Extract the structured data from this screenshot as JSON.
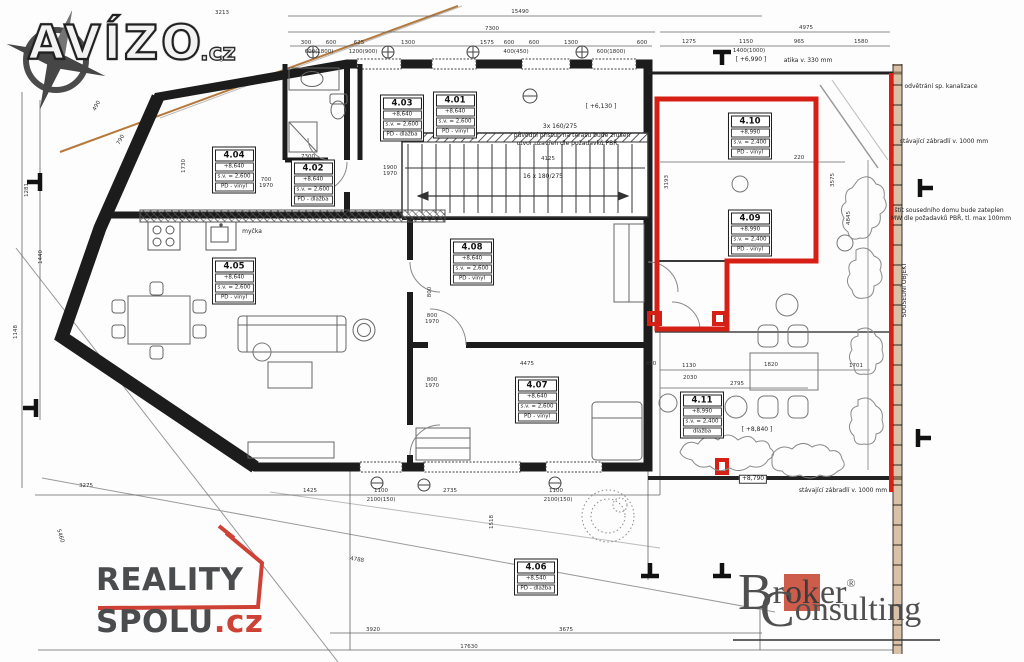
{
  "watermarks": {
    "avizo": {
      "name_part": "AVÍZO",
      "tld": ".cz"
    },
    "reality": {
      "line1": "REALITY",
      "line2": "SPOLU",
      "tld": ".cz",
      "red": "#ce4236"
    },
    "broker": {
      "b": "B",
      "roker_pre": "r",
      "ok": "ok",
      "roker_post": "er",
      "reg": "®",
      "c": "C",
      "onsulting": "onsulting",
      "accent": "#cd5c4b"
    }
  },
  "colors": {
    "highlight_red": "#d62015",
    "wall_black": "#1c1c1c",
    "boundary_orange": "#b5793d",
    "neighbor_band_tan": "#c8a078",
    "dim_text": "#333333"
  },
  "plan": {
    "rooms": [
      {
        "num": "4.01",
        "rows": [
          "+8,640",
          "s.v. = 2,600",
          "PD - vinyl"
        ],
        "x": 455,
        "y": 115
      },
      {
        "num": "4.03",
        "rows": [
          "+8,640",
          "s.v. = 2,600",
          "PD - dlažba"
        ],
        "x": 402,
        "y": 118
      },
      {
        "num": "4.02",
        "rows": [
          "+8,640",
          "s.v. = 2,600",
          "PD - dlažba"
        ],
        "x": 313,
        "y": 183
      },
      {
        "num": "4.04",
        "rows": [
          "+8,640",
          "s.v. = 2,600",
          "PD - vinyl"
        ],
        "x": 234,
        "y": 170
      },
      {
        "num": "4.05",
        "rows": [
          "+8,640",
          "s.v. = 2,600",
          "PD - vinyl"
        ],
        "x": 234,
        "y": 281
      },
      {
        "num": "4.08",
        "rows": [
          "+8,640",
          "s.v. = 2,600",
          "PD - vinyl"
        ],
        "x": 472,
        "y": 262
      },
      {
        "num": "4.07",
        "rows": [
          "+8,640",
          "s.v. = 2,600",
          "PD - vinyl"
        ],
        "x": 537,
        "y": 400
      },
      {
        "num": "4.06",
        "rows": [
          "+8,540",
          "PD - dlažba"
        ],
        "x": 536,
        "y": 577
      },
      {
        "num": "4.10",
        "rows": [
          "+8,990",
          "s.v. = 2,400",
          "PD - vinyl"
        ],
        "x": 750,
        "y": 136
      },
      {
        "num": "4.09",
        "rows": [
          "+8,990",
          "s.v. = 2,400",
          "PD - vinyl"
        ],
        "x": 750,
        "y": 233
      },
      {
        "num": "4.11",
        "rows": [
          "+8,990",
          "s.v. = 2,400",
          "dlažba"
        ],
        "x": 702,
        "y": 415
      }
    ],
    "dimensions": [
      {
        "t": "15490",
        "x": 520,
        "y": 12
      },
      {
        "t": "3213",
        "x": 222,
        "y": 13
      },
      {
        "t": "3546",
        "x": 226,
        "y": 58,
        "r": -27
      },
      {
        "t": "7300",
        "x": 492,
        "y": 29
      },
      {
        "t": "4975",
        "x": 806,
        "y": 28
      },
      {
        "t": "300",
        "x": 306,
        "y": 43
      },
      {
        "t": "600",
        "x": 331,
        "y": 43
      },
      {
        "t": "625",
        "x": 359,
        "y": 43
      },
      {
        "t": "1300",
        "x": 408,
        "y": 43
      },
      {
        "t": "1575",
        "x": 487,
        "y": 43
      },
      {
        "t": "600",
        "x": 509,
        "y": 43
      },
      {
        "t": "600",
        "x": 534,
        "y": 43
      },
      {
        "t": "1300",
        "x": 571,
        "y": 43
      },
      {
        "t": "600",
        "x": 642,
        "y": 43
      },
      {
        "t": "600(1800)",
        "x": 319,
        "y": 52
      },
      {
        "t": "1200(900)",
        "x": 363,
        "y": 52
      },
      {
        "t": "400(450)",
        "x": 516,
        "y": 52
      },
      {
        "t": "600(1800)",
        "x": 611,
        "y": 52
      },
      {
        "t": "1275",
        "x": 689,
        "y": 42
      },
      {
        "t": "1150",
        "x": 746,
        "y": 42
      },
      {
        "t": "965",
        "x": 799,
        "y": 42
      },
      {
        "t": "1580",
        "x": 861,
        "y": 42
      },
      {
        "t": "1400(1000)",
        "x": 749,
        "y": 51
      },
      {
        "t": "490",
        "x": 97,
        "y": 106,
        "r": -62
      },
      {
        "t": "790",
        "x": 121,
        "y": 140,
        "r": -62
      },
      {
        "t": "1281",
        "x": 27,
        "y": 190,
        "r": -90
      },
      {
        "t": "1440",
        "x": 41,
        "y": 257,
        "r": -90
      },
      {
        "t": "1148",
        "x": 16,
        "y": 332,
        "r": -90
      },
      {
        "t": "1730",
        "x": 184,
        "y": 166,
        "r": -90
      },
      {
        "t": "700",
        "x": 266,
        "y": 180
      },
      {
        "t": "1970",
        "x": 266,
        "y": 186
      },
      {
        "t": "7300",
        "x": 308,
        "y": 157
      },
      {
        "t": "1900",
        "x": 390,
        "y": 168
      },
      {
        "t": "1970",
        "x": 390,
        "y": 174
      },
      {
        "t": "4125",
        "x": 548,
        "y": 159
      },
      {
        "t": "3013",
        "x": 737,
        "y": 158
      },
      {
        "t": "220",
        "x": 799,
        "y": 158
      },
      {
        "t": "3193",
        "x": 667,
        "y": 182,
        "r": -90
      },
      {
        "t": "3575",
        "x": 833,
        "y": 180,
        "r": -90
      },
      {
        "t": "4845",
        "x": 849,
        "y": 218,
        "r": -90
      },
      {
        "t": "800",
        "x": 430,
        "y": 292,
        "r": -90
      },
      {
        "t": "800",
        "x": 432,
        "y": 316
      },
      {
        "t": "1970",
        "x": 432,
        "y": 322
      },
      {
        "t": "800",
        "x": 432,
        "y": 380
      },
      {
        "t": "1970",
        "x": 432,
        "y": 386
      },
      {
        "t": "4475",
        "x": 527,
        "y": 364
      },
      {
        "t": "450",
        "x": 651,
        "y": 364
      },
      {
        "t": "1130",
        "x": 689,
        "y": 366
      },
      {
        "t": "2030",
        "x": 690,
        "y": 378
      },
      {
        "t": "1820",
        "x": 771,
        "y": 365
      },
      {
        "t": "2795",
        "x": 737,
        "y": 384
      },
      {
        "t": "1701",
        "x": 856,
        "y": 366
      },
      {
        "t": "1518",
        "x": 492,
        "y": 522,
        "r": -90
      },
      {
        "t": "3275",
        "x": 86,
        "y": 486
      },
      {
        "t": "5460",
        "x": 60,
        "y": 536,
        "r": 73
      },
      {
        "t": "1425",
        "x": 310,
        "y": 491
      },
      {
        "t": "1100",
        "x": 381,
        "y": 491
      },
      {
        "t": "2100(150)",
        "x": 381,
        "y": 500
      },
      {
        "t": "2735",
        "x": 450,
        "y": 491
      },
      {
        "t": "1100",
        "x": 556,
        "y": 491
      },
      {
        "t": "2100(150)",
        "x": 558,
        "y": 500
      },
      {
        "t": "4788",
        "x": 357,
        "y": 560,
        "r": 9
      },
      {
        "t": "3920",
        "x": 373,
        "y": 630
      },
      {
        "t": "3675",
        "x": 566,
        "y": 630
      },
      {
        "t": "17630",
        "x": 469,
        "y": 647
      }
    ],
    "notes": [
      {
        "t": "odvětrání sp. kanalizace",
        "x": 941,
        "y": 87
      },
      {
        "t": "stávající zábradlí v. 1000 mm",
        "x": 944,
        "y": 142
      },
      {
        "t": "štít sousedního domu bude zateplen",
        "x": 949,
        "y": 211
      },
      {
        "t": "MW dle požadavků PBŘ, tl. max 100mm",
        "x": 951,
        "y": 219
      },
      {
        "t": "SOUSEDNÍ OBJEKT",
        "x": 905,
        "y": 290,
        "r": -90
      },
      {
        "t": "původní přístup na terasu bude zrušen",
        "x": 572,
        "y": 136
      },
      {
        "t": "otvor uzavřen dle požadavků PBŘ",
        "x": 567,
        "y": 144
      },
      {
        "t": "3x 160/275",
        "x": 560,
        "y": 127
      },
      {
        "t": "16 x 180/275",
        "x": 543,
        "y": 177
      },
      {
        "t": "myčka",
        "x": 252,
        "y": 232
      },
      {
        "t": "atika v. 330 mm",
        "x": 808,
        "y": 61
      },
      {
        "t": "[ +6,990 ]",
        "x": 751,
        "y": 60
      },
      {
        "t": "[ +6,130 ]",
        "x": 601,
        "y": 107
      },
      {
        "t": "[ +8,840 ]",
        "x": 757,
        "y": 430
      },
      {
        "t": "+8,790",
        "x": 753,
        "y": 479,
        "boxed": true
      },
      {
        "t": "stávající zábradlí v. 1000 mm",
        "x": 843,
        "y": 491
      }
    ]
  }
}
